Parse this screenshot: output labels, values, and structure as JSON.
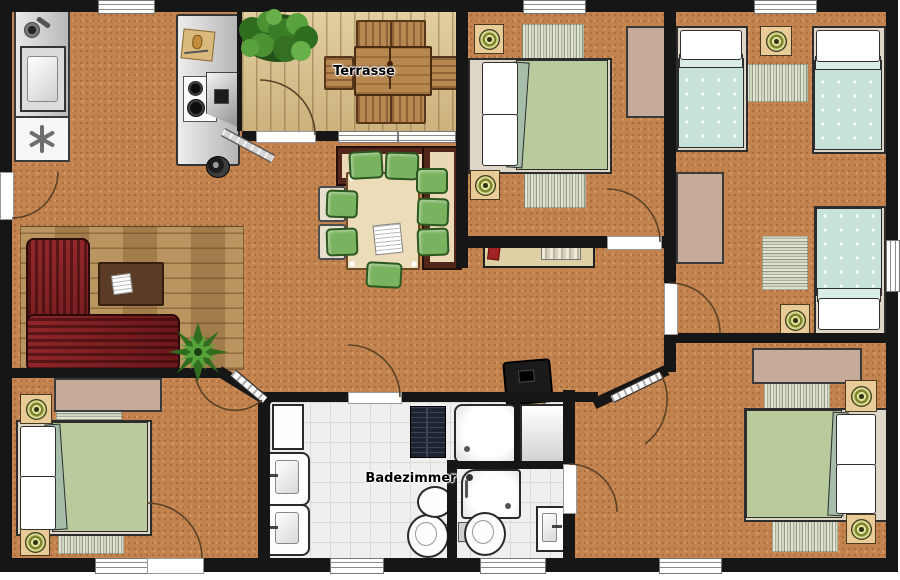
{
  "labels": {
    "terrace": "Terrasse",
    "bathroom": "Badezimmer"
  },
  "palette": {
    "wall": "#161616",
    "floor": "#c2834f",
    "deck": "#d8c18b",
    "wood_rug": "#b28a54",
    "tile": "#f0efed",
    "bed_green": "#b9cb9d",
    "bed_teal": "#c7e2da",
    "sofa_red": "#7e1b1e",
    "cushion_green": "#7ab35f",
    "furniture_tan": "#e8cb96",
    "wardrobe": "#c6ab9a",
    "bench_wood": "#53261b",
    "terrace_wood": "#b8874f",
    "door_arc": "#5a4328"
  }
}
